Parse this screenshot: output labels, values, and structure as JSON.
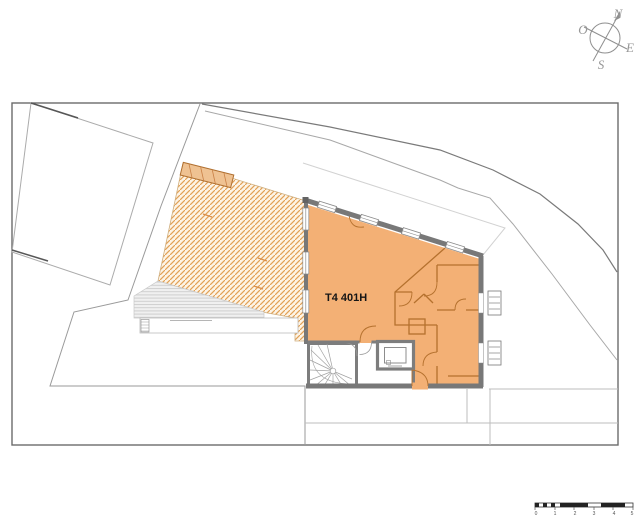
{
  "plan": {
    "unit": {
      "label": "T4 401H",
      "fill": "#f3b075"
    },
    "compass": {
      "north": "N",
      "east": "E",
      "south": "S",
      "west": "O"
    },
    "scalebar": {
      "labels": [
        "0",
        "1",
        "2",
        "3",
        "4",
        "5"
      ]
    },
    "colors": {
      "apartment_fill": "#f3b075",
      "terrace_hatch_line": "#e2a055",
      "terrace_hatch_bg": "#fdf4e6",
      "outer_wall": "#787878",
      "interior_wall": "#b5712e",
      "site_line": "#9a9a9a",
      "deck_line": "#cfcfcf"
    }
  }
}
